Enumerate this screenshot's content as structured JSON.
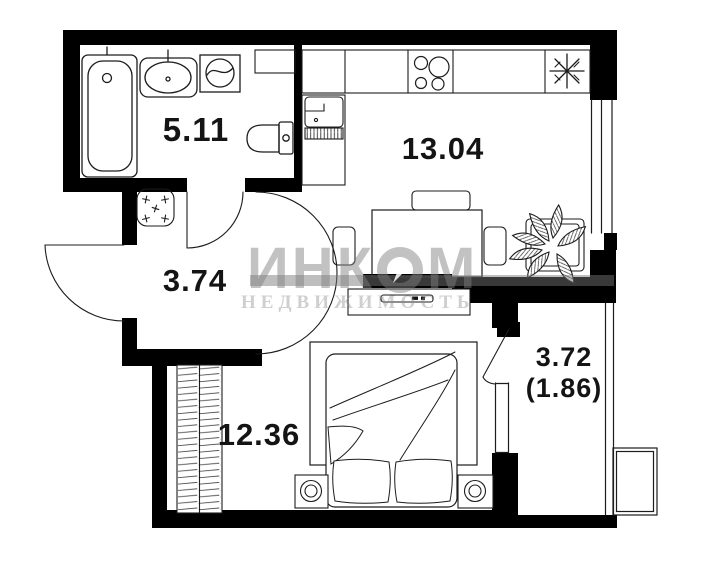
{
  "plan": {
    "rooms": [
      {
        "id": "bathroom",
        "area": "5.11"
      },
      {
        "id": "kitchen-living",
        "area": "13.04"
      },
      {
        "id": "hallway",
        "area": "3.74"
      },
      {
        "id": "bedroom",
        "area": "12.36"
      },
      {
        "id": "balcony",
        "area": "3.72",
        "area_reduced": "(1.86)"
      }
    ]
  },
  "watermark": {
    "brand_part1": "ИНК",
    "brand_part2": "М",
    "subtitle": "НЕДВИЖИМОСТЬ"
  },
  "colors": {
    "wall": "#000000",
    "line": "#1c1c1c",
    "background": "#ffffff",
    "watermark": "#808080"
  }
}
